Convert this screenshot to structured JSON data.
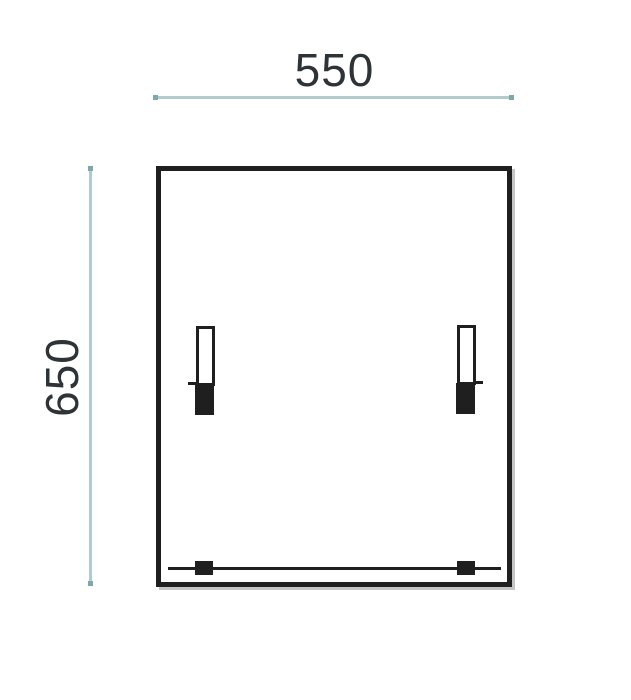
{
  "drawing": {
    "width_dimension": {
      "label": "550"
    },
    "height_dimension": {
      "label": "650"
    },
    "colors": {
      "background": "#ffffff",
      "dimension_line": "#b2cccc",
      "dimension_endpoint": "#7fa8a8",
      "outline": "#1f1f1f",
      "label_text": "#2e3338"
    }
  }
}
